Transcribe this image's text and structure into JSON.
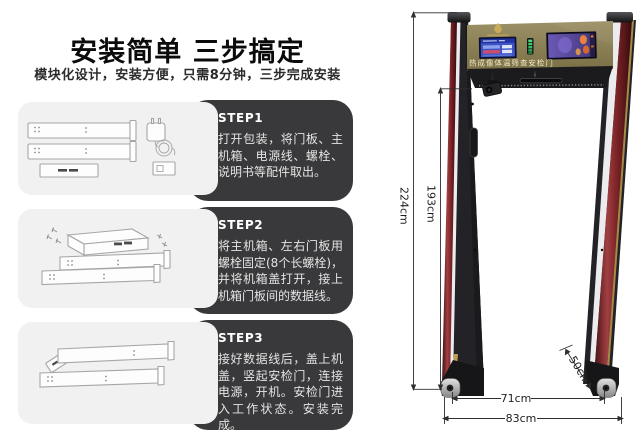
{
  "page": {
    "background": "#ffffff"
  },
  "header": {
    "title": "安装简单 三步搞定",
    "subtitle": "模块化设计，安装方便，只需8分钟，三步完成安装"
  },
  "steps": [
    {
      "label": "STEP1",
      "text": "打开包装，将门板、主机箱、电源线、螺栓、说明书等配件取出。"
    },
    {
      "label": "STEP2",
      "text": "将主机箱、左右门板用螺栓固定(8个长螺栓)，并将机箱盖打开，接上机箱门板间的数据线。"
    },
    {
      "label": "STEP3",
      "text": "接好数据线后，盖上机盖，竖起安检门，连接电源，开机。安检门进入工作状态。安装完成。"
    }
  ],
  "gate": {
    "nameplate": "热成像体温筛查安检门",
    "dimensions": {
      "outer_height": "224cm",
      "inner_height": "193cm",
      "inner_width": "71cm",
      "outer_width": "83cm",
      "base_depth": "50cm"
    },
    "icons": {
      "camera": "camera-icon",
      "brand_logo": "brand-logo-icon",
      "lcd": "lcd-display",
      "thermal": "thermal-display",
      "led": "led-indicator"
    },
    "colors": {
      "header_panel": "#8d815a",
      "pillar_red": "#7c2326",
      "body_black": "#232327",
      "screen_blue": "#3d53c6",
      "thermal_purple": "#584a9a",
      "led_green": "#35bd63",
      "gold_trim": "#bf9c4e"
    }
  }
}
